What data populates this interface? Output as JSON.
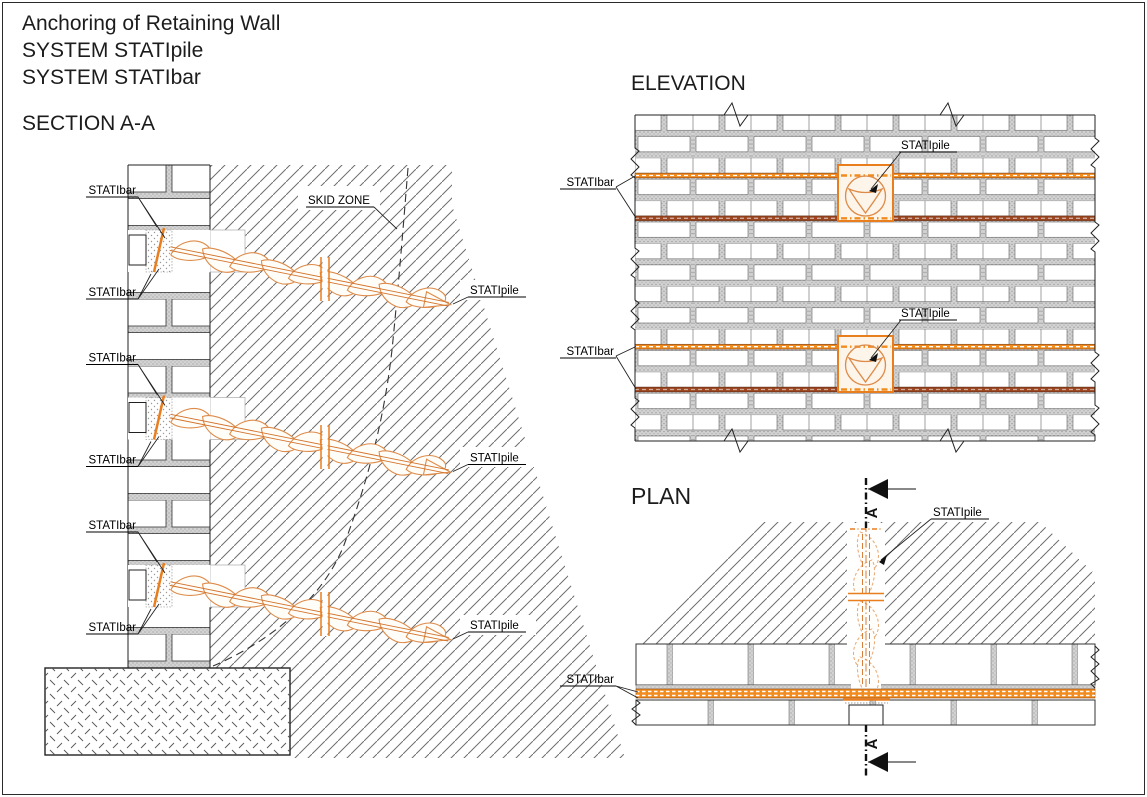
{
  "titles": {
    "line1": "Anchoring of Retaining Wall",
    "line2": "SYSTEM STATIpile",
    "line3": "SYSTEM STATIbar",
    "section": "SECTION A-A",
    "elevation": "ELEVATION",
    "plan": "PLAN"
  },
  "labels": {
    "statibar": "STATIbar",
    "statipile": "STATIpile",
    "skid_zone": "SKID ZONE",
    "section_letter": "A"
  },
  "colors": {
    "orange": "#E87E1E",
    "helix": "#DD8B4A",
    "dark_bar": "#9C4722",
    "band": "#F28C1E",
    "hatch": "#6E6E6E"
  }
}
